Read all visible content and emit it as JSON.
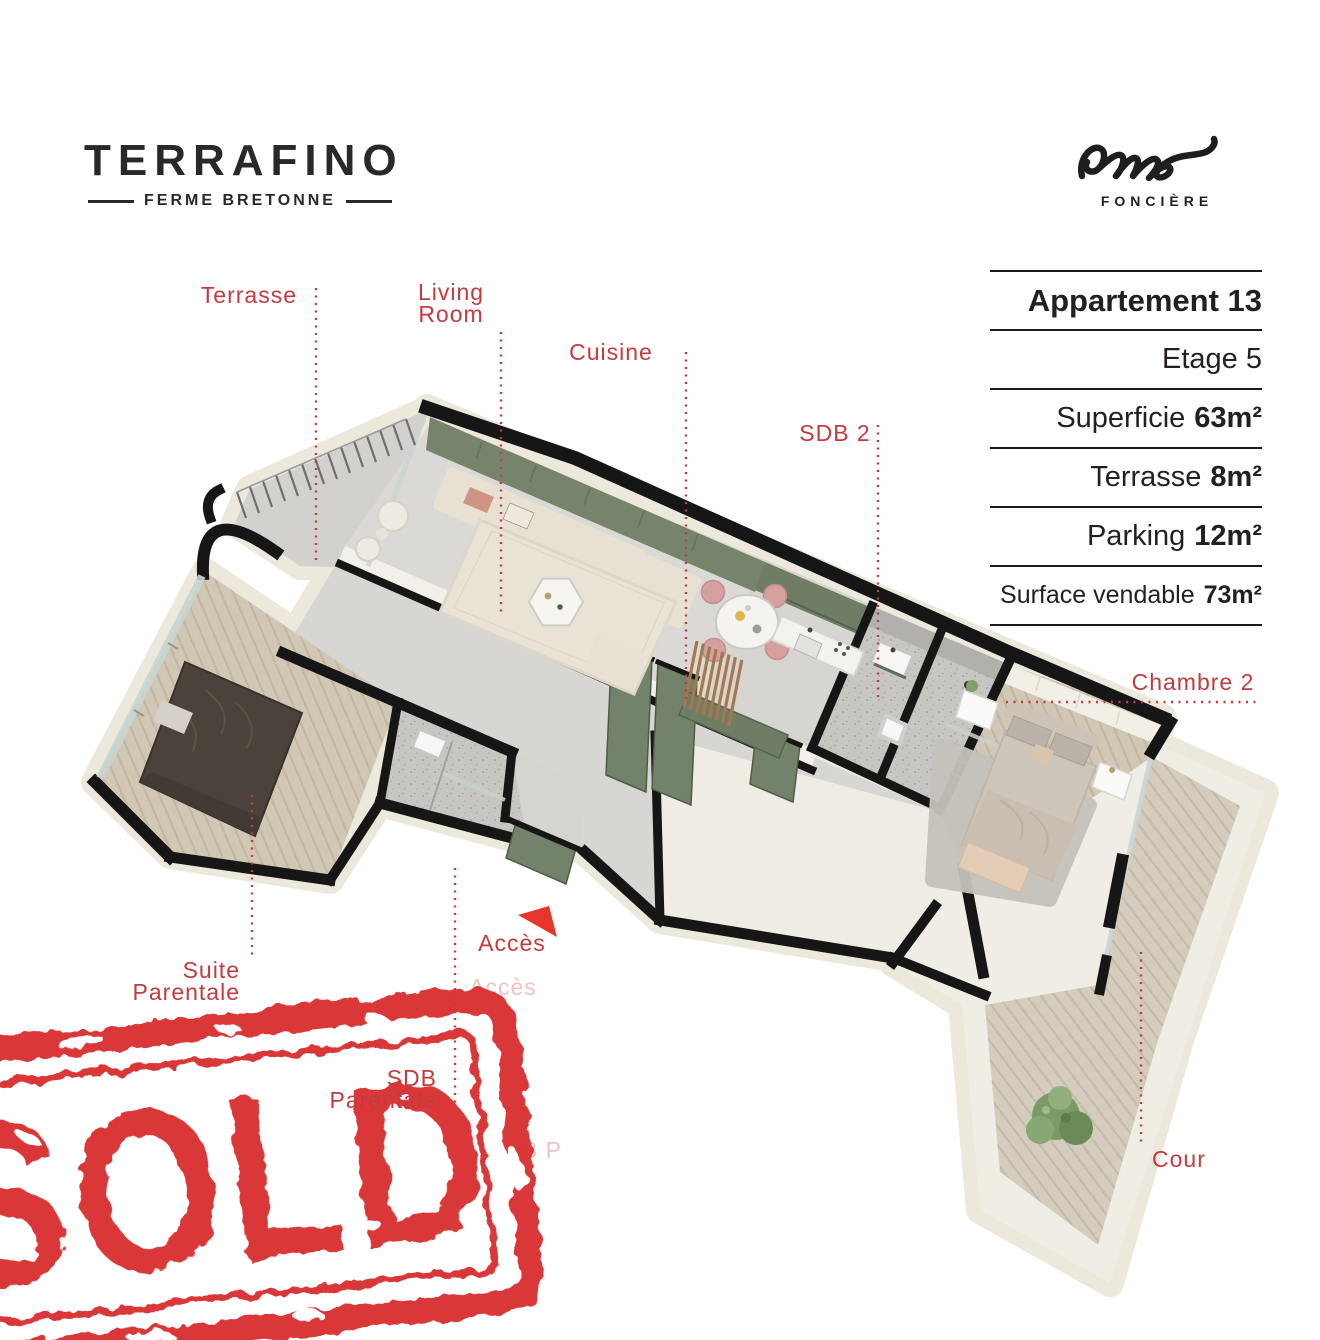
{
  "brand": {
    "name": "TERRAFINO",
    "tagline": "FERME BRETONNE"
  },
  "partner_logo": {
    "script_word": "one",
    "subtitle": "FONCIÈRE"
  },
  "info_panel": {
    "rows": [
      {
        "label": "Appartement 13",
        "value": ""
      },
      {
        "label": "Etage 5",
        "value": ""
      },
      {
        "label": "Superficie",
        "value": "63m²"
      },
      {
        "label": "Terrasse",
        "value": "8m²"
      },
      {
        "label": "Parking",
        "value": "12m²"
      },
      {
        "label": "Surface vendable",
        "value": "73m²"
      }
    ]
  },
  "floor_plan_labels": {
    "terrasse": {
      "text": "Terrasse"
    },
    "living_room": {
      "line1": "Living",
      "line2": "Room"
    },
    "cuisine": {
      "text": "Cuisine"
    },
    "sdb2": {
      "text": "SDB 2"
    },
    "chambre2": {
      "text": "Chambre 2"
    },
    "suite_parentale": {
      "line1": "Suite",
      "line2": "Parentale"
    },
    "sdb_parentale": {
      "line1": "SDB",
      "line2": "Parentale"
    },
    "acces": {
      "text": "Accès"
    },
    "cour": {
      "text": "Cour"
    },
    "ghost_acces": {
      "text": "Accès"
    },
    "ghost_fragment": {
      "text": "B P"
    }
  },
  "stamp": {
    "text": "SOLD"
  },
  "colors": {
    "label_red": "#c43a3f",
    "stamp_red": "#d93231",
    "arrow_red": "#e8342b",
    "wall_green": "#76846c",
    "wall_black": "#161616",
    "cream": "#f0ede4",
    "wood": "#d0c6b4",
    "floor_gray": "#d8d6d2",
    "bath_gray": "#b2b0ac"
  }
}
